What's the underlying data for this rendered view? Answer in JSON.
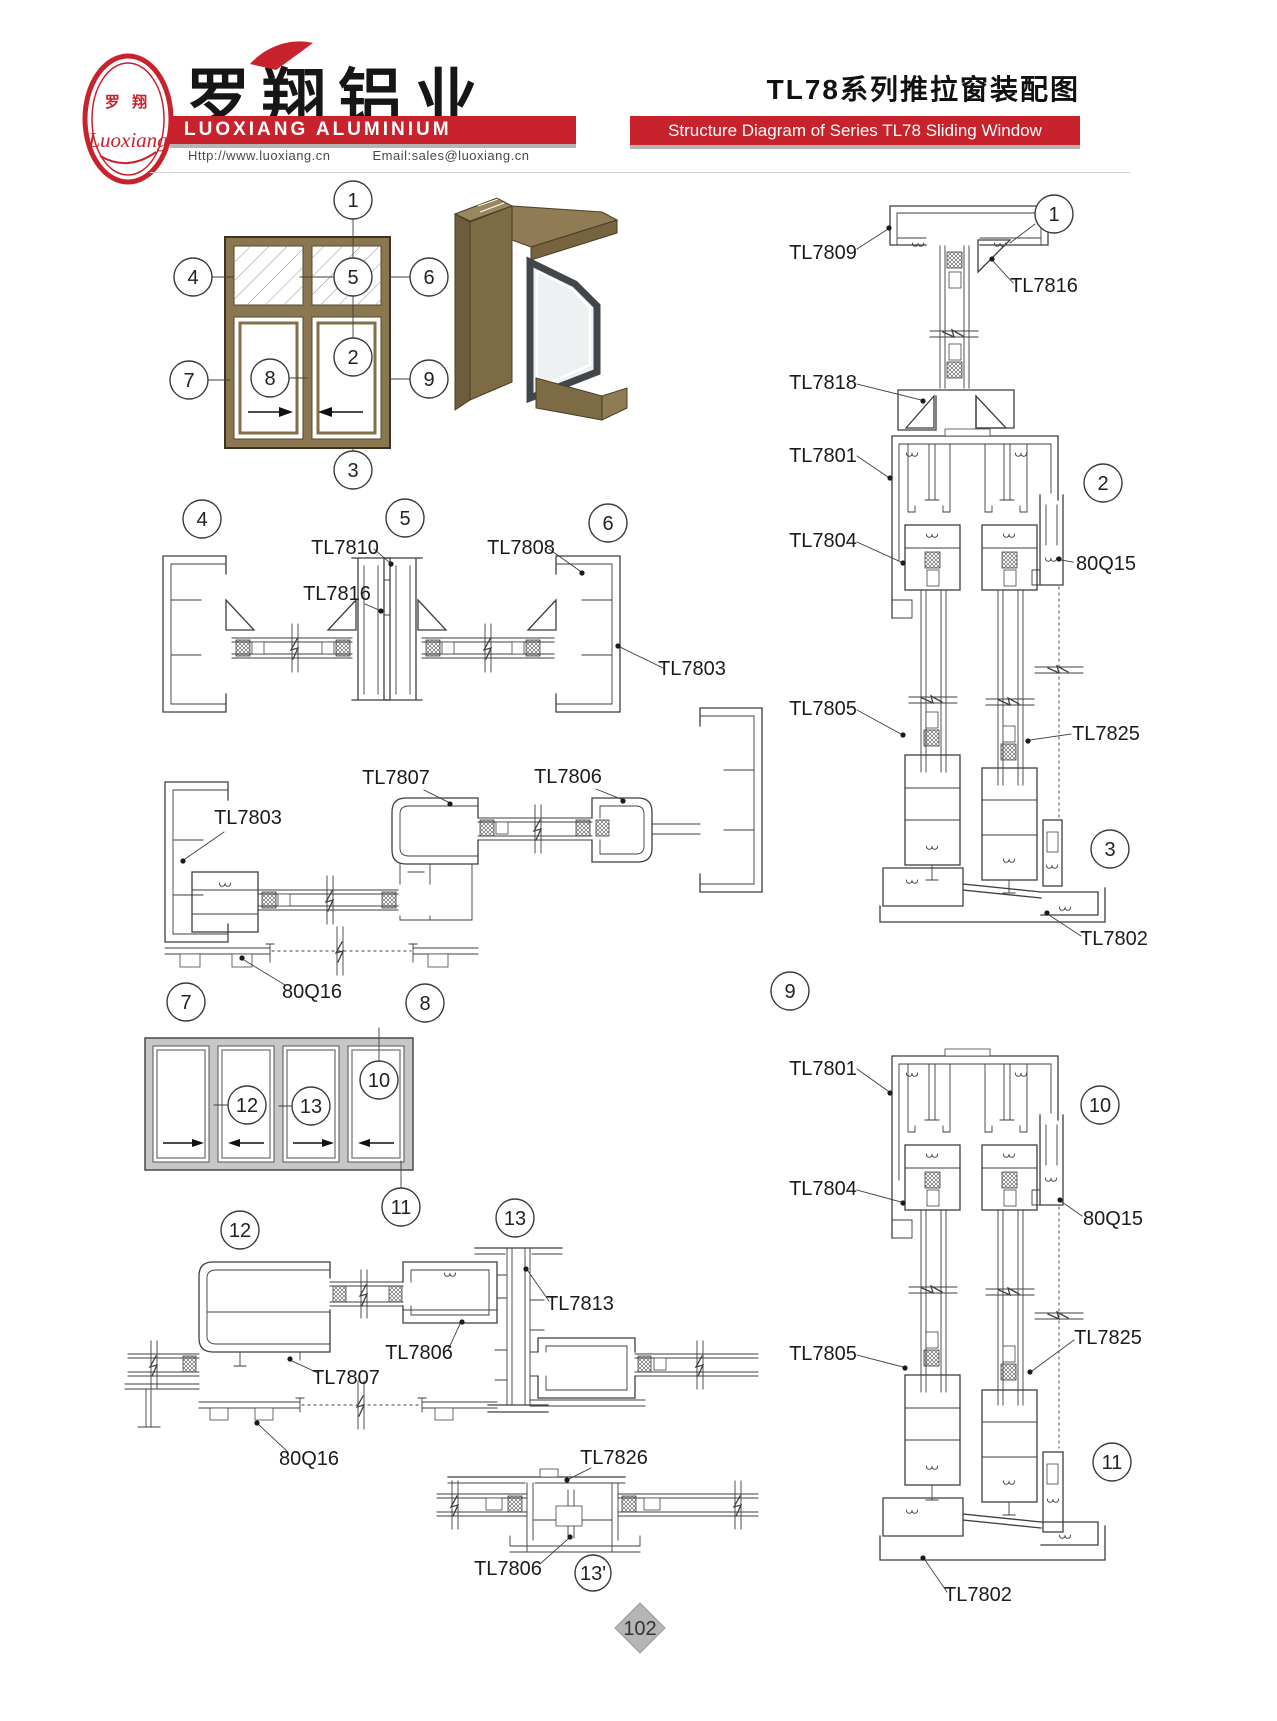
{
  "header": {
    "logo": {
      "cn": "罗 翔",
      "script": "Luoxiang"
    },
    "company_cn": "罗翔铝业",
    "company_en": "LUOXIANG ALUMINIUM",
    "website": "Http://www.luoxiang.cn",
    "email": "Email:sales@luoxiang.cn",
    "title_cn": "TL78系列推拉窗装配图",
    "title_en": "Structure Diagram of Series TL78 Sliding Window"
  },
  "callouts": {
    "c1": "1",
    "c2": "2",
    "c3": "3",
    "c4": "4",
    "c5": "5",
    "c6": "6",
    "c7": "7",
    "c8": "8",
    "c9": "9",
    "c10": "10",
    "c11": "11",
    "c12": "12",
    "c13": "13",
    "c13p": "13'"
  },
  "parts": {
    "tl7801": "TL7801",
    "tl7802": "TL7802",
    "tl7803": "TL7803",
    "tl7804": "TL7804",
    "tl7805": "TL7805",
    "tl7806": "TL7806",
    "tl7807": "TL7807",
    "tl7808": "TL7808",
    "tl7809": "TL7809",
    "tl7810": "TL7810",
    "tl7813": "TL7813",
    "tl7816": "TL7816",
    "tl7818": "TL7818",
    "tl7825": "TL7825",
    "tl7826": "TL7826",
    "q15": "80Q15",
    "q16": "80Q16"
  },
  "page_number": "102",
  "colors": {
    "accent": "#c8232c",
    "line": "#3f3f3f",
    "frame_brown": "#8a7650",
    "frame_gray": "#c7c7c7"
  }
}
